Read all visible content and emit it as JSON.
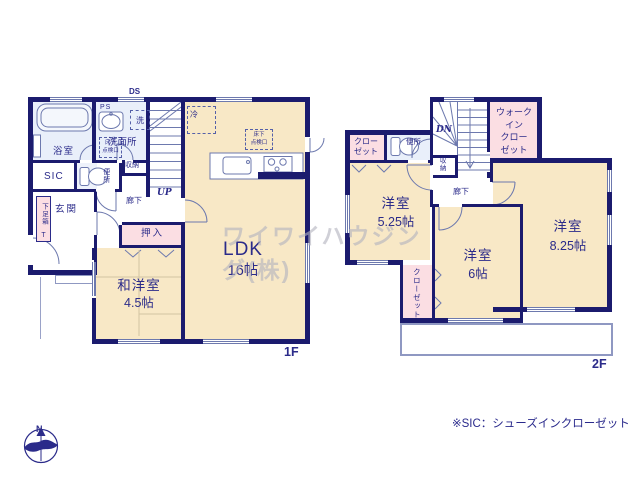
{
  "watermark": "ワイワイハウジング(株)",
  "note": "※SIC：シューズインクローゼット",
  "compass_n": "N",
  "floor1": {
    "label": "1F",
    "ds": "DS",
    "ps": "PS",
    "washer": "洗",
    "bathroom": "浴室",
    "washroom": "洗面所",
    "underfloor_hatch": [
      "床下",
      "点検口"
    ],
    "storage": "収納",
    "toilet": "便所",
    "sic": "SIC",
    "shoe_box": "下足箱",
    "shoe_box_t": "T",
    "entrance": "玄関",
    "hallway": "廊下",
    "up": "UP",
    "oshiire": "押入",
    "washitsu_name": "和洋室",
    "washitsu_size": "4.5帖",
    "ldk_name": "LDK",
    "ldk_size": "16帖",
    "fridge": "冷",
    "underfloor_hatch_ldk": [
      "床下",
      "点検口"
    ]
  },
  "floor2": {
    "label": "2F",
    "dn": "DN",
    "closet_nw": [
      "クロー",
      "ゼット"
    ],
    "toilet": "便所",
    "storage": "収納",
    "wic": [
      "ウォーク",
      "イン",
      "クロー",
      "ゼット"
    ],
    "hallway": "廊下",
    "room1_name": "洋室",
    "room1_size": "5.25帖",
    "room2_name": "洋室",
    "room2_size": "6帖",
    "room3_name": "洋室",
    "room3_size": "8.25帖",
    "closet_s": "クローゼット"
  }
}
